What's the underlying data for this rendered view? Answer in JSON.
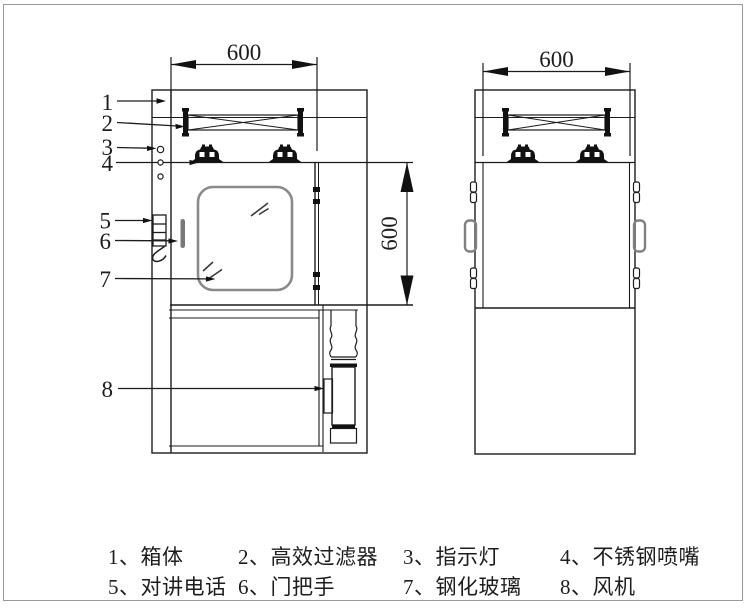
{
  "dims": {
    "front_width": "600",
    "front_height": "600",
    "side_width": "600"
  },
  "callouts": [
    "1",
    "2",
    "3",
    "4",
    "5",
    "6",
    "7",
    "8"
  ],
  "legend": {
    "items": [
      "1、箱体",
      "2、高效过滤器",
      "3、指示灯",
      "4、不锈钢喷嘴",
      "5、对讲电话",
      "6、门把手",
      "7、钢化玻璃",
      "8、风机"
    ]
  },
  "colors": {
    "line": "#1c1c1c",
    "glass_stroke": "#8a8a8a",
    "border": "#9a9a9a",
    "background": "#ffffff"
  }
}
